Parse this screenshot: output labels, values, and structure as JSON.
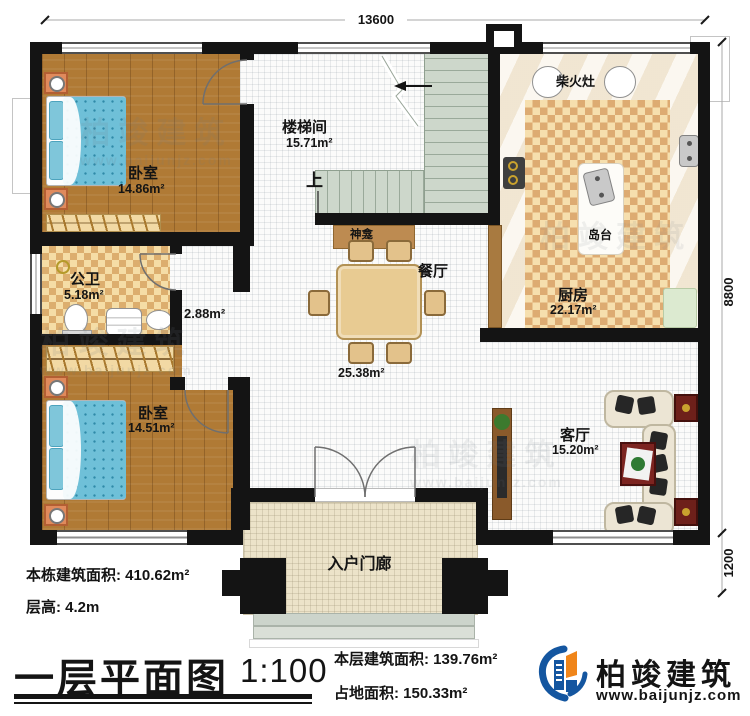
{
  "dimensions": {
    "width_top": "13600",
    "height_right": "8800",
    "porch_height": "1200"
  },
  "rooms": {
    "bedroom1": {
      "name": "卧室",
      "area": "14.86m²"
    },
    "stairwell": {
      "name": "楼梯间",
      "area": "15.71m²"
    },
    "kitchen": {
      "name": "厨房",
      "area": "22.17m²"
    },
    "bathroom": {
      "name": "公卫",
      "area": "5.18m²"
    },
    "corridor": {
      "area": "2.88m²"
    },
    "bedroom2": {
      "name": "卧室",
      "area": "14.51m²"
    },
    "dining": {
      "name": "餐厅",
      "area": "25.38m²"
    },
    "living": {
      "name": "客厅",
      "area": "15.20m²"
    },
    "porch": {
      "name": "入户门廊"
    }
  },
  "features": {
    "wood_stove": "柴火灶",
    "island": "岛台",
    "shrine": "神龛",
    "stairs_up": "上"
  },
  "notes": {
    "building_area_label": "本栋建筑面积:",
    "building_area_value": "410.62m²",
    "floor_height_label": "层高:",
    "floor_height_value": "4.2m"
  },
  "title_block": {
    "title": "一层平面图",
    "scale": "1:100",
    "floor_area_label": "本层建筑面积:",
    "floor_area_value": "139.76m²",
    "footprint_label": "占地面积:",
    "footprint_value": "150.33m²"
  },
  "brand": {
    "name": "柏竣建筑",
    "website": "www.baijunjz.com"
  },
  "watermark": {
    "name": "柏竣建筑",
    "website": "www.baijunjz.com"
  },
  "colors": {
    "wall": "#141414",
    "brand_blue": "#1456a0",
    "brand_orange": "#f08519",
    "wood": "#b07a35",
    "stair": "#cdd7cb",
    "porch": "#ece3c9"
  }
}
